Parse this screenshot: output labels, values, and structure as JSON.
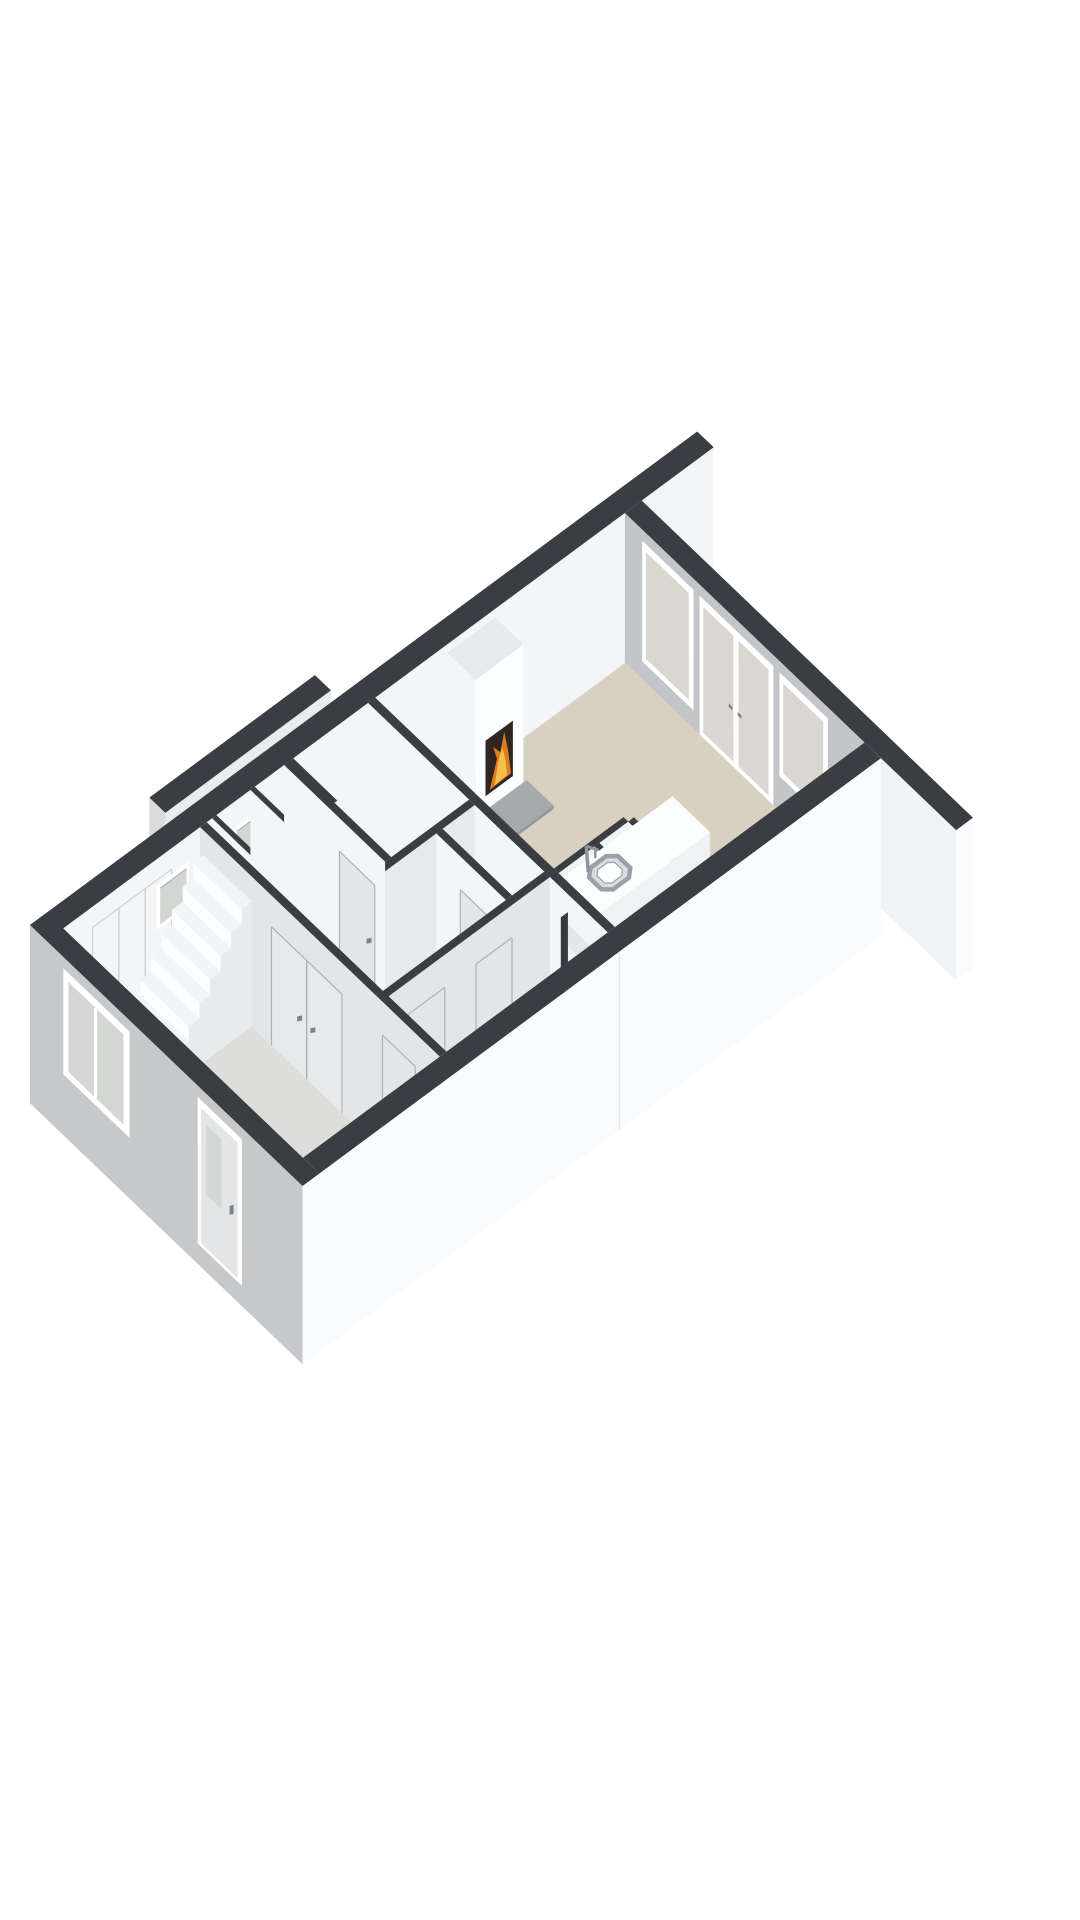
{
  "meta": {
    "title": "3D floor plan render — ground floor (isometric view)",
    "render_style": "floorplan-3d-cutaway",
    "background": "#ffffff"
  },
  "palette": {
    "bg": "#ffffff",
    "wallTop": "#3a3d41",
    "innerWhite": "#f3f5f7",
    "innerShade": "#e7e9eb",
    "innerGray": "#c3c5c8",
    "facadeFront": "#c6c8ca",
    "facadeRight": "#fafbfc",
    "stubWhite": "#f0f2f4",
    "capShade": "#d9dbdd",
    "annexFace": "#e9ebed",
    "floorLiving": "#d8d1c2",
    "floorHall": "#dddedc",
    "floorRooms": "#e3e4e2",
    "floorCells": "#ebecea",
    "floorPantry": "#e9e8e2",
    "hearth": "#a7aaad",
    "hearthEdge": "#94979a",
    "fireBox": "#2e2721",
    "fireOrange": "#e07c20",
    "fireYellow": "#f5c04e",
    "glassWarm": "#d9d7d0",
    "glassCool": "#d4d6d4",
    "frame": "#ffffff",
    "doorFace": "#e3e5e7",
    "doorSeam": "#aeb1b4",
    "handle": "#7f8286",
    "islandTop": "#fcfdfd",
    "islandFront": "#eff1f3",
    "islandEnd": "#e5e7e9",
    "sinkRim": "#9aa0a5",
    "sinkBasin": "#dadde0",
    "faucet": "#8f959a",
    "tread": "#f3f4f6",
    "riser": "#fcfdfe",
    "stringer": "#e8eaec",
    "reveal": "#35383c",
    "seamLight": "#cfd1d3"
  },
  "features": [
    {
      "name": "left-party-wall-extension",
      "label": "party wall extension (back left)"
    },
    {
      "name": "right-party-wall-extension",
      "label": "party wall extension (back right)"
    },
    {
      "name": "side-annex-wall",
      "label": "low annex wall along left facade"
    },
    {
      "name": "left-facade-wall",
      "label": "left facade with two slit windows"
    },
    {
      "name": "back-wall",
      "label": "rear wall with window, french doors, window"
    },
    {
      "name": "living-room",
      "label": "living room with beige floor"
    },
    {
      "name": "fireplace",
      "label": "fireplace with burning fire and hearth plate"
    },
    {
      "name": "kitchen-island",
      "label": "kitchen island with sink and faucet"
    },
    {
      "name": "pantry-cells",
      "label": "pantry / storage cells beside kitchen"
    },
    {
      "name": "doorway-opening",
      "label": "open doorway between corridor and living room"
    },
    {
      "name": "middle-rooms",
      "label": "bathroom, toilet and storage rooms"
    },
    {
      "name": "hallway",
      "label": "entrance hall"
    },
    {
      "name": "staircase",
      "label": "staircase ascending to upper floor"
    },
    {
      "name": "front-facade-wall",
      "label": "front facade"
    },
    {
      "name": "front-window",
      "label": "front window"
    },
    {
      "name": "front-door",
      "label": "front door with glass pane"
    },
    {
      "name": "right-facade-wall",
      "label": "right facade (outer white wall)"
    }
  ]
}
